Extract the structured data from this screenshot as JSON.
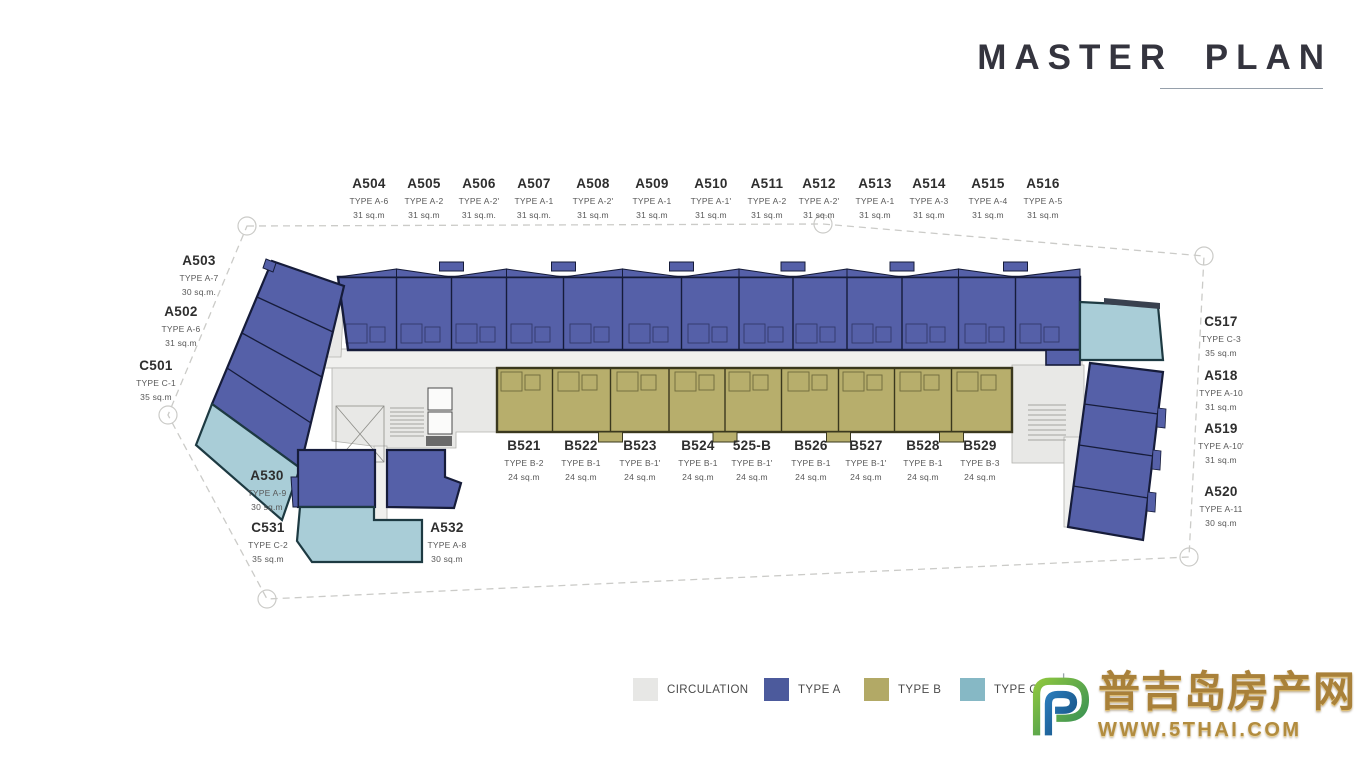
{
  "title": "MASTER PLAN",
  "plan": {
    "unit_labels": [
      {
        "id": "A504",
        "type": "TYPE A-6",
        "area": "31 sq.m",
        "x": 369,
        "y": 176,
        "row": "top"
      },
      {
        "id": "A505",
        "type": "TYPE A-2",
        "area": "31 sq.m",
        "x": 424,
        "y": 176,
        "row": "top"
      },
      {
        "id": "A506",
        "type": "TYPE A-2'",
        "area": "31 sq.m.",
        "x": 479,
        "y": 176,
        "row": "top"
      },
      {
        "id": "A507",
        "type": "TYPE A-1",
        "area": "31 sq.m.",
        "x": 534,
        "y": 176,
        "row": "top"
      },
      {
        "id": "A508",
        "type": "TYPE A-2'",
        "area": "31 sq.m",
        "x": 593,
        "y": 176,
        "row": "top"
      },
      {
        "id": "A509",
        "type": "TYPE A-1",
        "area": "31 sq.m",
        "x": 652,
        "y": 176,
        "row": "top"
      },
      {
        "id": "A510",
        "type": "TYPE A-1'",
        "area": "31 sq.m",
        "x": 711,
        "y": 176,
        "row": "top"
      },
      {
        "id": "A511",
        "type": "TYPE A-2",
        "area": "31 sq.m",
        "x": 767,
        "y": 176,
        "row": "top"
      },
      {
        "id": "A512",
        "type": "TYPE A-2'",
        "area": "31 sq.m",
        "x": 819,
        "y": 176,
        "row": "top"
      },
      {
        "id": "A513",
        "type": "TYPE A-1",
        "area": "31 sq.m",
        "x": 875,
        "y": 176,
        "row": "top"
      },
      {
        "id": "A514",
        "type": "TYPE A-3",
        "area": "31 sq.m",
        "x": 929,
        "y": 176,
        "row": "top"
      },
      {
        "id": "A515",
        "type": "TYPE A-4",
        "area": "31 sq.m",
        "x": 988,
        "y": 176,
        "row": "top"
      },
      {
        "id": "A516",
        "type": "TYPE A-5",
        "area": "31 sq.m",
        "x": 1043,
        "y": 176,
        "row": "top"
      },
      {
        "id": "B521",
        "type": "TYPE B-2",
        "area": "24 sq.m",
        "x": 524,
        "y": 438,
        "row": "b"
      },
      {
        "id": "B522",
        "type": "TYPE B-1",
        "area": "24 sq.m",
        "x": 581,
        "y": 438,
        "row": "b"
      },
      {
        "id": "B523",
        "type": "TYPE B-1'",
        "area": "24 sq.m",
        "x": 640,
        "y": 438,
        "row": "b"
      },
      {
        "id": "B524",
        "type": "TYPE B-1",
        "area": "24 sq.m",
        "x": 698,
        "y": 438,
        "row": "b"
      },
      {
        "id": "525-B",
        "type": "TYPE B-1'",
        "area": "24 sq.m",
        "x": 752,
        "y": 438,
        "row": "b"
      },
      {
        "id": "B526",
        "type": "TYPE B-1",
        "area": "24 sq.m",
        "x": 811,
        "y": 438,
        "row": "b"
      },
      {
        "id": "B527",
        "type": "TYPE B-1'",
        "area": "24 sq.m",
        "x": 866,
        "y": 438,
        "row": "b"
      },
      {
        "id": "B528",
        "type": "TYPE B-1",
        "area": "24 sq.m",
        "x": 923,
        "y": 438,
        "row": "b"
      },
      {
        "id": "B529",
        "type": "TYPE B-3",
        "area": "24 sq.m",
        "x": 980,
        "y": 438,
        "row": "b"
      },
      {
        "id": "A503",
        "type": "TYPE A-7",
        "area": "30 sq.m.",
        "x": 199,
        "y": 253,
        "row": "left"
      },
      {
        "id": "A502",
        "type": "TYPE A-6",
        "area": "31 sq.m",
        "x": 181,
        "y": 304,
        "row": "left"
      },
      {
        "id": "C501",
        "type": "TYPE C-1",
        "area": "35 sq.m",
        "x": 156,
        "y": 358,
        "row": "left"
      },
      {
        "id": "C517",
        "type": "TYPE C-3",
        "area": "35 sq.m",
        "x": 1221,
        "y": 314,
        "row": "right"
      },
      {
        "id": "A518",
        "type": "TYPE A-10",
        "area": "31 sq.m",
        "x": 1221,
        "y": 368,
        "row": "right"
      },
      {
        "id": "A519",
        "type": "TYPE A-10'",
        "area": "31 sq.m",
        "x": 1221,
        "y": 421,
        "row": "right"
      },
      {
        "id": "A520",
        "type": "TYPE A-11",
        "area": "30 sq.m",
        "x": 1221,
        "y": 484,
        "row": "right"
      },
      {
        "id": "A530",
        "type": "TYPE A-9",
        "area": "30 sq.m",
        "x": 267,
        "y": 468,
        "row": "bottom"
      },
      {
        "id": "C531",
        "type": "TYPE C-2",
        "area": "35 sq.m",
        "x": 268,
        "y": 520,
        "row": "bottom"
      },
      {
        "id": "A532",
        "type": "TYPE A-8",
        "area": "30 sq.m",
        "x": 447,
        "y": 520,
        "row": "bottom"
      }
    ]
  },
  "legend": {
    "y": 678,
    "items": [
      {
        "label": "CIRCULATION",
        "color": "#e7e7e5",
        "x": 633
      },
      {
        "label": "TYPE A",
        "color": "#4c5a9c",
        "x": 764
      },
      {
        "label": "TYPE B",
        "color": "#b2a966",
        "x": 864
      },
      {
        "label": "TYPE C",
        "color": "#86b8c5",
        "x": 960
      }
    ]
  },
  "watermark": {
    "chinese": "普吉岛房产网",
    "url": "WWW.5THAI.COM"
  },
  "colors": {
    "type_a": "#5560a8",
    "type_a_dark": "#161c3a",
    "type_b": "#b7ae6c",
    "type_b_dark": "#3a381e",
    "type_c": "#a9cdd7",
    "type_c_dark": "#1d3a42",
    "circulation": "#e8e8e6",
    "corridor": "#f0f0ee",
    "boundary": "#cbcbc8",
    "label_text": "#3c3c3c",
    "title_text": "#34343e",
    "watermark_gold": "#a9813a"
  }
}
